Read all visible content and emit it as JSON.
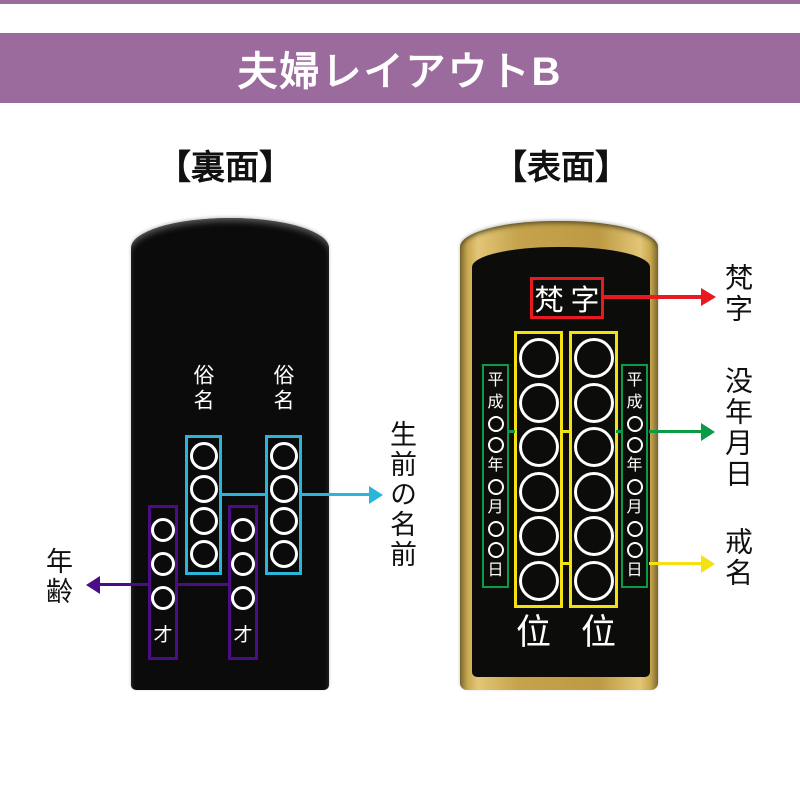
{
  "banner": {
    "title": "夫婦レイアウトB"
  },
  "back_section": {
    "heading": "【裏面】",
    "name_labels": [
      "俗名",
      "俗名"
    ],
    "age_char": "才",
    "cyan_circle_count": 4,
    "violet_circle_count": 3,
    "annotations": {
      "lifetime_name": "生前の名前",
      "age": "年齢"
    }
  },
  "front_section": {
    "heading": "【表面】",
    "bonji_text": "梵字",
    "date_items": [
      "平",
      "成",
      "○",
      "○",
      "年",
      "○",
      "月",
      "○",
      "○",
      "日"
    ],
    "yellow_circle_count": 6,
    "rank_chars": [
      "位",
      "位"
    ],
    "annotations": {
      "bonji": "梵字",
      "death_date": "没年月日",
      "kaimyo": "戒名"
    }
  },
  "colors": {
    "banner_purple": "#9c6b9e",
    "cyan": "#29b6d9",
    "violet": "#4a0d87",
    "red": "#e8191f",
    "green": "#0a9b47",
    "yellow": "#f4e112",
    "gold": "#c5a24b",
    "tablet_black": "#0b0b0b"
  }
}
